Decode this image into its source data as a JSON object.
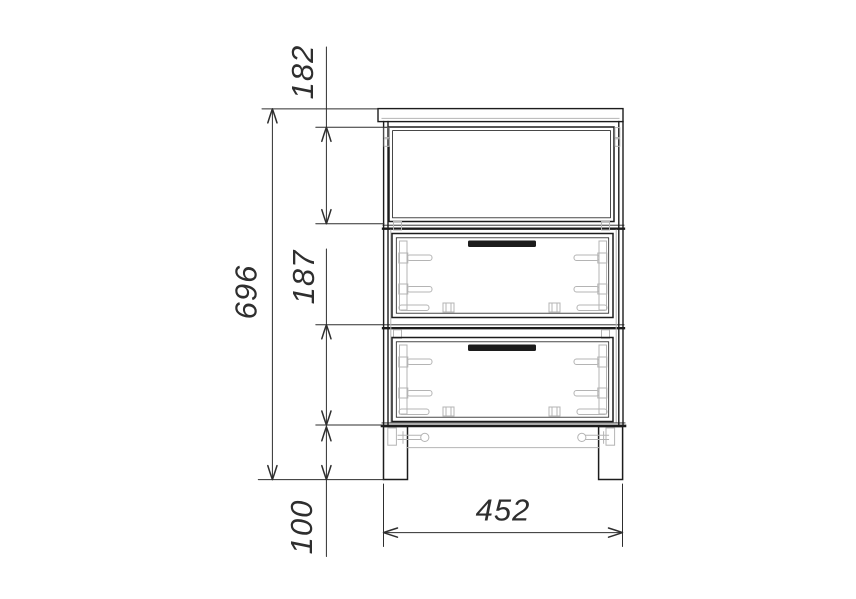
{
  "dimensions": {
    "overall_height": "696",
    "top_niche_height": "182",
    "drawer_section_height": "187",
    "plinth_height": "100",
    "overall_width": "452"
  },
  "colors": {
    "background": "#ffffff",
    "outline": "#1c1c1c",
    "hidden_detail": "#b4b4b4",
    "dimension_lines": "#2e2e2e"
  }
}
